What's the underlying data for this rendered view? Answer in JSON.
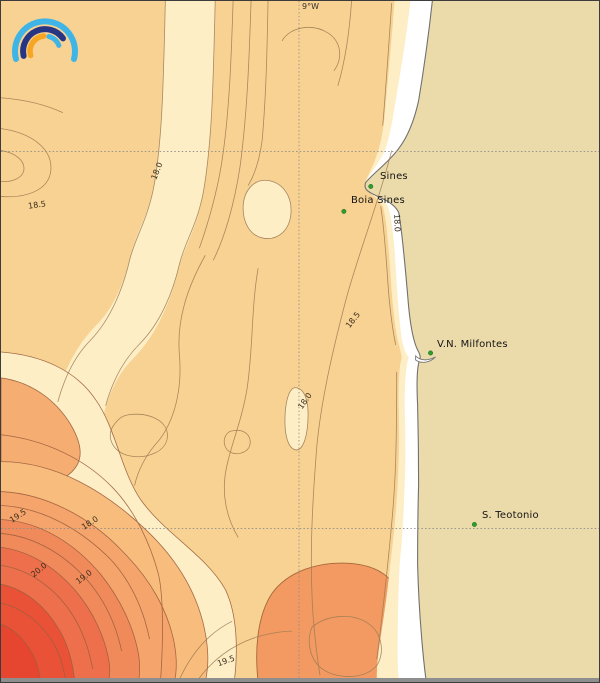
{
  "logo": {
    "arc_colors": {
      "outer_arc": "#3FB4E6",
      "middle_arc": "#283583",
      "inner_left_arc": "#F6A623",
      "inner_right_arc": "#3FB4E6"
    }
  },
  "map": {
    "meridian_label": "9°W",
    "places": [
      {
        "name": "Sines",
        "dot_x": 371,
        "dot_y": 186
      },
      {
        "name": "Boia Sines",
        "dot_x": 344,
        "dot_y": 211
      },
      {
        "name": "V.N. Milfontes",
        "dot_x": 431,
        "dot_y": 353
      },
      {
        "name": "S. Teotonio",
        "dot_x": 475,
        "dot_y": 525
      }
    ],
    "contour_labels": [
      {
        "text": "18.0",
        "x": 156,
        "y": 170
      },
      {
        "text": "18.5",
        "x": 36,
        "y": 204
      },
      {
        "text": "18.5",
        "x": 352,
        "y": 319
      },
      {
        "text": "18.0",
        "x": 304,
        "y": 400
      },
      {
        "text": "18.0",
        "x": 396,
        "y": 222
      },
      {
        "text": "19.5",
        "x": 17,
        "y": 515
      },
      {
        "text": "18.0",
        "x": 89,
        "y": 522
      },
      {
        "text": "20.0",
        "x": 38,
        "y": 569
      },
      {
        "text": "19.0",
        "x": 83,
        "y": 576
      },
      {
        "text": "19.5",
        "x": 225,
        "y": 660
      }
    ],
    "contour_levels_shown": [
      "18.0",
      "18.5",
      "19.0",
      "19.5",
      "20.0"
    ],
    "marker_color": "#2F9E2F",
    "palette": {
      "sea": "#F8D292",
      "cool": "#FDEEC6",
      "land": "#ECDBAA",
      "surf": "#FFFFFF",
      "warm_patch": "#F6AD72",
      "south_blob": "#F29A62",
      "warm_bands": [
        "#F8BD7D",
        "#F5A46C",
        "#F18A5B",
        "#EE6F4B",
        "#EA5237",
        "#E64530"
      ],
      "contour_line": "#9C7A52",
      "coastline": "#707070",
      "gridline": "#8A8A8A"
    }
  }
}
